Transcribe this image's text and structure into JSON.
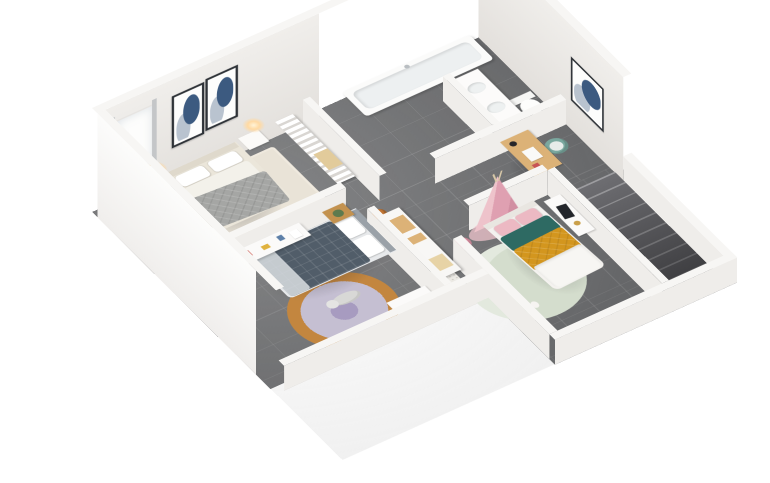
{
  "scene": {
    "description": "3D isometric dollhouse render of an apartment upper floor seen from above at an angle, white background, dark grey tiled floors, white cutaway walls",
    "view": "isometric-top-down-dollhouse",
    "palette": {
      "background": "#ffffff",
      "floor_tile": "#6c6d6f",
      "wall_top": "#f7f6f4",
      "wall_face": "#e9e7e4",
      "glow_warm": "#ffd9a2",
      "stair_mid": "#6e6e72",
      "stair_edge": "#9d9da0",
      "wood": "#c3924f",
      "wood_light": "#dcb277",
      "bed_cream": "#ebe6da",
      "duvet_gray": "#a5a6a4",
      "duvet_navy": "#515d69",
      "fold_light": "#d9dee2",
      "teal": "#2e6a63",
      "teal_chair": "#7ba89f",
      "armchair_teal": "#5d8795",
      "mustard": "#d3961e",
      "blush": "#d9ab9e",
      "pink": "#ecb9c3",
      "pink_deep": "#dd93a6",
      "pink_tent": "#eec3cb",
      "pink_tent_dark": "#dfa0b1",
      "orange_rug": "#c3863f",
      "lavender": "#c5bfd2",
      "lavender_deep": "#a79bc0",
      "cream_rug": "#e8decc",
      "mint": "#d4ddcd",
      "master_rug": "#e9e3d7",
      "ball_orange": "#bf7434",
      "ball_black": "#2a2a2e",
      "art_navy": "#3c5a80",
      "art_dark": "#2f3338",
      "plant_green": "#5d7a4e",
      "chrome": "#b9bec2"
    },
    "rooms": [
      {
        "name": "master-bedroom",
        "items": [
          "double-bed-gray-quilt",
          "two-glowing-table-lamps",
          "two-nightstands",
          "two-framed-abstract-art",
          "window-with-curtains",
          "beige-area-rug",
          "teal-armchair",
          "wood-plant-table"
        ]
      },
      {
        "name": "walk-in-closet",
        "items": [
          "wardrobe-with-hanging-clothes",
          "beige-storage-box"
        ]
      },
      {
        "name": "bathroom",
        "items": [
          "bathtub",
          "shower-fixture",
          "window",
          "double-sink-vanity",
          "partition-wall",
          "toilet"
        ]
      },
      {
        "name": "office-nook",
        "items": [
          "wooden-desk",
          "black-desk-lamp",
          "papers",
          "teal-desk-chair",
          "framed-abstract-art"
        ]
      },
      {
        "name": "kids-bedroom-blue",
        "items": [
          "single-bed-navy-duvet",
          "white-desk-with-art-supplies",
          "blush-chair",
          "wood-nightstand-with-plant",
          "floor-lamp",
          "round-layered-rug",
          "plush-polar-bear",
          "white-dresser"
        ]
      },
      {
        "name": "hallway",
        "items": [
          "storage-closet-with-wood-boxes",
          "basketball",
          "black-ball",
          "toy-jack",
          "dotted-mat"
        ]
      },
      {
        "name": "kids-bedroom-pink",
        "items": [
          "pink-teepee-tent",
          "single-bed-mustard-teal",
          "round-mint-rug",
          "white-desk-with-tablet",
          "gold-lamp",
          "stool",
          "pink-pouf",
          "small-toys"
        ]
      },
      {
        "name": "staircase",
        "items": [
          "descending-gray-stairs",
          "white-railing-walls"
        ]
      }
    ]
  }
}
